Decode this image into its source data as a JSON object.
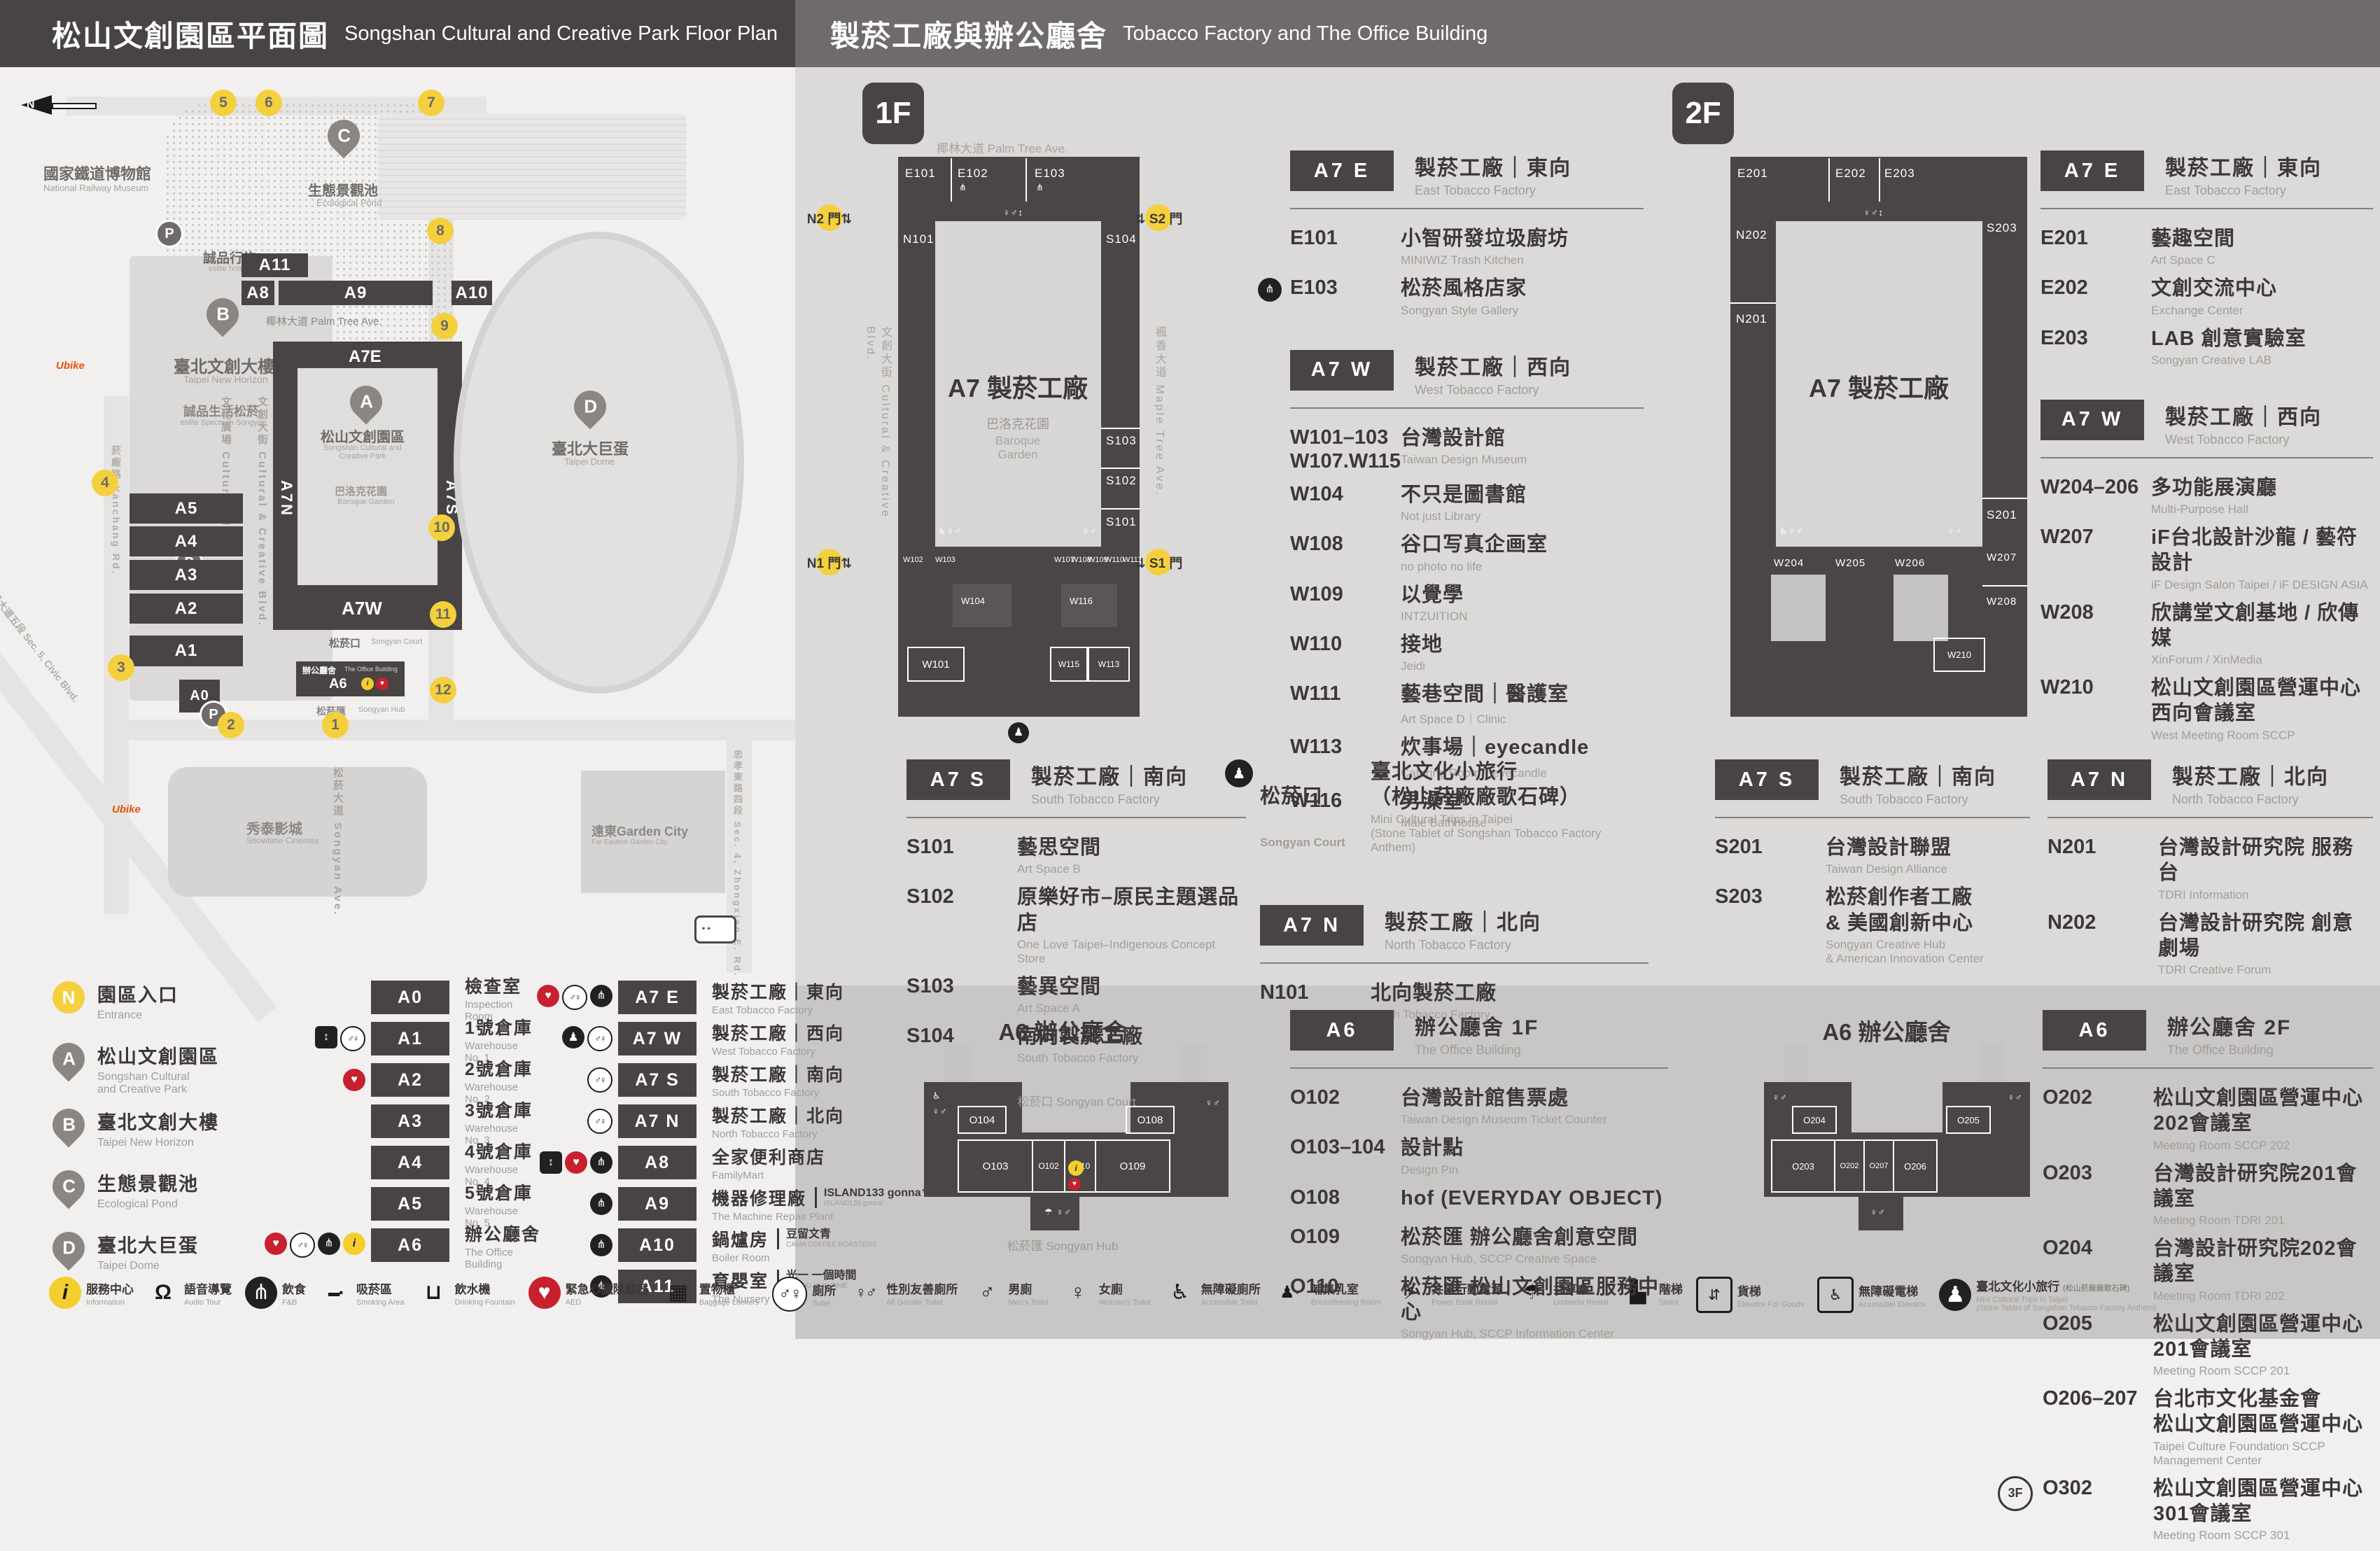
{
  "header": {
    "left_zh": "松山文創園區平面圖",
    "left_en": "Songshan Cultural and Creative Park Floor Plan",
    "right_zh": "製菸工廠與辦公廳舍",
    "right_en": "Tobacco Factory and The Office Building"
  },
  "map": {
    "north": "N",
    "railway_zh": "國家鐵道博物館",
    "railway_en": "National Railway Museum",
    "pond_zh": "生態景觀池",
    "pond_en": "Ecological Pond",
    "eslite_hotel_zh": "誠品行旅",
    "eslite_hotel_en": "eslite hotel",
    "new_horizon_zh": "臺北文創大樓",
    "new_horizon_en": "Taipei New Horizon",
    "spectrum_zh": "誠品生活松菸",
    "spectrum_en": "eslite Spectrum Songyan",
    "park_zh": "松山文創園區",
    "park_en": "Songshan Cultural and\nCreative Park",
    "baroque_zh": "巴洛克花園",
    "baroque_en": "Baroque Garden",
    "dome_zh": "臺北大巨蛋",
    "dome_en": "Taipei Dome",
    "showtime_zh": "秀泰影城",
    "showtime_en": "Showtime Cinemas",
    "garden_city": "遠東Garden City",
    "garden_city_en": "Far Eastern Garden City",
    "court_zh": "松菸口",
    "court_en": "Songyan Court",
    "office_zh": "辦公廳舍",
    "office_en": "The Office Building",
    "hub_zh": "松菸匯",
    "hub_en": "Songyan Hub",
    "palm": "椰林大道 Palm Tree Ave.",
    "cultural_plaza": "文化廣場 Cultural Plaza",
    "cc_blvd": "文創大街 Cultural & Creative Blvd.",
    "maple": "楓香大道 Maple Tree Ave.",
    "songyan_ave": "松菸大道 Songyan Ave.",
    "yanchang": "菸廠路 Yanchang Rd.",
    "civic": "市民大道五段 Sec. 5, Civic Blvd.",
    "zhongxiao": "忠孝東路四段 Sec. 4, Zhongxiao E. Rd.",
    "ub": "Ubike",
    "pins": {
      "a": "A",
      "b": "B",
      "c": "C",
      "d": "D"
    },
    "gates": [
      "1",
      "2",
      "3",
      "4",
      "5",
      "6",
      "7",
      "8",
      "9",
      "10",
      "11",
      "12"
    ],
    "b": {
      "a0": "A0",
      "a1": "A1",
      "a2": "A2",
      "a3": "A3",
      "a4": "A4",
      "a5": "A5",
      "a6": "A6",
      "a7e": "A7E",
      "a7w": "A7W",
      "a7n": "A7N",
      "a7s": "A7S",
      "a8": "A8",
      "a9": "A9",
      "a10": "A10",
      "a11": "A11"
    }
  },
  "legend": {
    "places": [
      {
        "kind": "entrance",
        "key": "N",
        "name": "entrance-marker",
        "zh": "園區入口",
        "en": "Entrance"
      },
      {
        "kind": "pin",
        "key": "A",
        "name": "pin-a",
        "zh": "松山文創園區",
        "en": "Songshan Cultural\nand Creative Park"
      },
      {
        "kind": "pin",
        "key": "B",
        "name": "pin-b",
        "zh": "臺北文創大樓",
        "en": "Taipei New Horizon"
      },
      {
        "kind": "pin",
        "key": "C",
        "name": "pin-c",
        "zh": "生態景觀池",
        "en": "Ecological Pond"
      },
      {
        "kind": "pin",
        "key": "D",
        "name": "pin-d",
        "zh": "臺北大巨蛋",
        "en": "Taipei Dome"
      }
    ],
    "buildings": [
      {
        "code": "A0",
        "zh": "檢查室",
        "en": "Inspection Room",
        "icons": []
      },
      {
        "code": "A1",
        "zh": "1號倉庫",
        "en": "Warehouse No. 1",
        "icons": [
          "elevator-icon",
          "toilet-icon"
        ]
      },
      {
        "code": "A2",
        "zh": "2號倉庫",
        "en": "Warehouse No. 2",
        "icons": [
          "aed-icon"
        ]
      },
      {
        "code": "A3",
        "zh": "3號倉庫",
        "en": "Warehouse No. 3",
        "icons": []
      },
      {
        "code": "A4",
        "zh": "4號倉庫",
        "en": "Warehouse No. 4",
        "icons": []
      },
      {
        "code": "A5",
        "zh": "5號倉庫",
        "en": "Warehouse No. 5",
        "icons": []
      },
      {
        "code": "A6",
        "zh": "辦公廳舍",
        "en": "The Office Building",
        "icons": [
          "aed-icon",
          "toilet-icon",
          "food-icon",
          "info-icon"
        ]
      }
    ],
    "factory": [
      {
        "code": "A7 E",
        "zh": "製菸工廠｜東向",
        "en": "East Tobacco Factory",
        "icons": [
          "aed-icon",
          "toilet-icon",
          "food-icon"
        ]
      },
      {
        "code": "A7 W",
        "zh": "製菸工廠｜西向",
        "en": "West Tobacco Factory",
        "icons": [
          "court-icon",
          "toilet-icon"
        ]
      },
      {
        "code": "A7 S",
        "zh": "製菸工廠｜南向",
        "en": "South Tobacco Factory",
        "icons": [
          "toilet-icon"
        ]
      },
      {
        "code": "A7 N",
        "zh": "製菸工廠｜北向",
        "en": "North Tobacco Factory",
        "icons": [
          "toilet-icon"
        ]
      },
      {
        "code": "A8",
        "zh": "全家便利商店",
        "en": "FamilyMart",
        "icons": [
          "elevator-icon",
          "aed-icon",
          "food-icon"
        ]
      },
      {
        "code": "A9",
        "zh": "機器修理廠",
        "en": "The Machine Repair Plant",
        "icons": [
          "food-icon"
        ],
        "p1": "ISLAND133 gonna⁺",
        "p2": "ISLAND133 gonna⁺"
      },
      {
        "code": "A10",
        "zh": "鍋爐房",
        "en": "Boiler Room",
        "icons": [
          "food-icon"
        ],
        "p1": "豆留文青",
        "p2": "CAMA COFFEE ROASTERS"
      },
      {
        "code": "A11",
        "zh": "育嬰室",
        "en": "The Nursery Room",
        "icons": [
          "food-icon"
        ],
        "p1": "光一 一個時間",
        "p2": "GUANG YI IN TIME"
      }
    ]
  },
  "icon_strip": [
    {
      "icon": "info-icon",
      "zh": "服務中心",
      "en": "Information"
    },
    {
      "icon": "audio-icon",
      "zh": "語音導覽",
      "en": "Audio Tour"
    },
    {
      "icon": "food-icon",
      "zh": "飲食",
      "en": "F&B"
    },
    {
      "icon": "smoke-icon",
      "zh": "吸菸區",
      "en": "Smoking Area"
    },
    {
      "icon": "water-icon",
      "zh": "飲水機",
      "en": "Drinking Fountain"
    },
    {
      "icon": "aed-icon",
      "zh": "緊急心臟除顫器",
      "en": "AED"
    },
    {
      "icon": "locker-icon",
      "zh": "置物櫃",
      "en": "Baggage Lockers"
    },
    {
      "icon": "toilet-icon",
      "zh": "廁所",
      "en": "Toilet"
    },
    {
      "icon": "allgender-icon",
      "zh": "性別友善廁所",
      "en": "All Gender Toilet"
    },
    {
      "icon": "men-icon",
      "zh": "男廁",
      "en": "Men's Toilet"
    },
    {
      "icon": "women-icon",
      "zh": "女廁",
      "en": "Women's Toilet"
    },
    {
      "icon": "access-icon",
      "zh": "無障礙廁所",
      "en": "Accessible Toilet"
    },
    {
      "icon": "nursing-icon",
      "zh": "哺集乳室",
      "en": "Breastfeeding Room"
    },
    {
      "icon": "power-icon",
      "zh": "共享行動電源",
      "en": "Power Bank Rental"
    },
    {
      "icon": "umbrella-icon",
      "zh": "共享傘",
      "en": "Umbrella Rental"
    },
    {
      "icon": "stairs-icon",
      "zh": "階梯",
      "en": "Stairs"
    },
    {
      "icon": "goods-elevator-icon",
      "zh": "貨梯",
      "en": "Elevator For Goods"
    },
    {
      "icon": "accessible-elevator-icon",
      "zh": "無障礙電梯",
      "en": "Accessible Elevator"
    },
    {
      "icon": "court-icon",
      "zh": "臺北文化小旅行",
      "zh2": "(松山菸廠廠歌石碑)",
      "en": "Mini Cultural Trips in Taipei\n(Stone Tablet of Songshan Tobacco Factory Anthem)"
    }
  ],
  "f1": {
    "badge": "1F",
    "plan": {
      "street": "椰林大道 Palm Tree Ave.",
      "left_street": "文創大街 Cultural & Creative Blvd.",
      "right_street": "楓香大道 Maple Tree Ave.",
      "center_zh": "A7 製菸工廠",
      "court_zh": "巴洛克花園",
      "court_en": "Baroque\nGarden",
      "gates": {
        "n2": "N2 門⇅",
        "s2": "⇅ S2 門",
        "n1": "N1 門⇅",
        "s1": "⇅ S1 門"
      },
      "rooms": {
        "e101": "E101",
        "e102": "E102",
        "e103": "E103",
        "n101": "N101",
        "s101": "S101",
        "s102": "S102",
        "s103": "S103",
        "s104": "S104",
        "w101": "W101",
        "w102": "W102",
        "w103": "W103",
        "w104": "W104",
        "w107": "W107",
        "w108": "W108",
        "w109": "W109",
        "w110": "W110",
        "w111": "W111",
        "w113": "W113",
        "w115": "W115",
        "w116": "W116"
      }
    },
    "sections_main": [
      {
        "badge": "A7 E",
        "zh": "製菸工廠｜東向",
        "en": "East Tobacco Factory",
        "rows": [
          {
            "code": "E101",
            "zh": "小智研發垃圾廚坊",
            "en": "MINIWIZ Trash Kitchen"
          },
          {
            "icon": "food-icon",
            "code": "E103",
            "zh": "松菸風格店家",
            "en": "Songyan Style Gallery"
          }
        ]
      },
      {
        "badge": "A7 W",
        "zh": "製菸工廠｜西向",
        "en": "West Tobacco Factory",
        "rows": [
          {
            "code": "W101–103\nW107.W115",
            "zh": "台灣設計館",
            "en": "Taiwan Design Museum"
          },
          {
            "code": "W104",
            "zh": "不只是圖書館",
            "en": "Not just Library"
          },
          {
            "code": "W108",
            "zh": "谷口写真企画室",
            "en": "no photo no life"
          },
          {
            "code": "W109",
            "zh": "以覺學",
            "en": "INTZUITION"
          },
          {
            "code": "W110",
            "zh": "接地",
            "en": "Jeidi"
          },
          {
            "code": "W111",
            "zh": "藝巷空間｜醫護室",
            "en": "Art Space D｜Clinic"
          },
          {
            "code": "W113",
            "zh": "炊事場｜eyecandle",
            "en": "Catering Room｜eyecandle"
          },
          {
            "code": "W116",
            "zh": "男澡堂",
            "en": "Male Bathhouse"
          }
        ]
      }
    ],
    "sections_south": [
      {
        "badge": "A7 S",
        "zh": "製菸工廠｜南向",
        "en": "South Tobacco Factory",
        "rows": [
          {
            "code": "S101",
            "zh": "藝思空間",
            "en": "Art Space B"
          },
          {
            "code": "S102",
            "zh": "原樂好市–原民主題選品店",
            "en": "One Love Taipei–Indigenous Concept Store"
          },
          {
            "code": "S103",
            "zh": "藝異空間",
            "en": "Art Space A"
          },
          {
            "code": "S104",
            "zh": "南向製菸工廠",
            "en": "South Tobacco Factory"
          }
        ]
      }
    ],
    "court": {
      "icon": "court-icon",
      "zh": "松菸口",
      "en": "Songyan Court",
      "name_zh": "臺北文化小旅行\n（松山菸廠廠歌石碑）",
      "name_en": "Mini Cultural Trips in Taipei\n(Stone Tablet of Songshan Tobacco Factory Anthem)"
    },
    "sections_north": [
      {
        "badge": "A7 N",
        "zh": "製菸工廠｜北向",
        "en": "North Tobacco Factory",
        "rows": [
          {
            "code": "N101",
            "zh": "北向製菸工廠",
            "en": "North Tobacco Factory"
          }
        ]
      }
    ],
    "a6_plan": {
      "title": "A6 辦公廳舍",
      "court": "松菸口 Songyan Court",
      "hub": "松菸匯 Songyan Hub",
      "rooms": {
        "o102": "O102",
        "o103": "O103",
        "o104": "O104",
        "o108": "O108",
        "o109": "O109",
        "o110": "O110"
      }
    },
    "a6_list": {
      "badge": "A6",
      "zh": "辦公廳舍 1F",
      "en": "The Office Building",
      "rows": [
        {
          "code": "O102",
          "zh": "台灣設計館售票處",
          "en": "Taiwan Design Museum Ticket Counter"
        },
        {
          "code": "O103–104",
          "zh": "設計點",
          "en": "Design Pin"
        },
        {
          "code": "O108",
          "zh": "hof (EVERYDAY OBJECT)"
        },
        {
          "code": "O109",
          "zh": "松菸匯 辦公廳舍創意空間",
          "en": "Songyan Hub, SCCP Creative Space"
        },
        {
          "code": "O110",
          "zh": "松菸匯 松山文創園區服務中心",
          "en": "Songyan Hub, SCCP Information Center"
        }
      ]
    }
  },
  "f2": {
    "badge": "2F",
    "plan": {
      "center_zh": "A7 製菸工廠",
      "rooms": {
        "e201": "E201",
        "e202": "E202",
        "e203": "E203",
        "n201": "N201",
        "n202": "N202",
        "s201": "S201",
        "s203": "S203",
        "w204": "W204",
        "w205": "W205",
        "w206": "W206",
        "w207": "W207",
        "w208": "W208",
        "w210": "W210"
      }
    },
    "sections_main": [
      {
        "badge": "A7 E",
        "zh": "製菸工廠｜東向",
        "en": "East Tobacco Factory",
        "rows": [
          {
            "code": "E201",
            "zh": "藝趣空間",
            "en": "Art Space C"
          },
          {
            "code": "E202",
            "zh": "文創交流中心",
            "en": "Exchange Center"
          },
          {
            "code": "E203",
            "zh": "LAB 創意實驗室",
            "en": "Songyan Creative LAB"
          }
        ]
      },
      {
        "badge": "A7 W",
        "zh": "製菸工廠｜西向",
        "en": "West Tobacco Factory",
        "rows": [
          {
            "code": "W204–206",
            "zh": "多功能展演廳",
            "en": "Multi-Purpose Hall"
          },
          {
            "code": "W207",
            "zh": "iF台北設計沙龍 / 藝符設計",
            "en": "iF Design Salon Taipei / iF DESIGN ASIA"
          },
          {
            "code": "W208",
            "zh": "欣講堂文創基地 / 欣傳媒",
            "en": "XinForum / XinMedia"
          },
          {
            "code": "W210",
            "zh": "松山文創園區營運中心\n西向會議室",
            "en": "West Meeting Room SCCP"
          }
        ]
      }
    ],
    "sections_south": [
      {
        "badge": "A7 S",
        "zh": "製菸工廠｜南向",
        "en": "South Tobacco Factory",
        "rows": [
          {
            "code": "S201",
            "zh": "台灣設計聯盟",
            "en": "Taiwan Design Alliance"
          },
          {
            "code": "S203",
            "zh": "松菸創作者工廠\n& 美國創新中心",
            "en": "Songyan Creative Hub\n& American Innovation Center"
          }
        ]
      }
    ],
    "sections_north": [
      {
        "badge": "A7 N",
        "zh": "製菸工廠｜北向",
        "en": "North Tobacco Factory",
        "rows": [
          {
            "code": "N201",
            "zh": "台灣設計研究院 服務台",
            "en": "TDRI Information"
          },
          {
            "code": "N202",
            "zh": "台灣設計研究院 創意劇場",
            "en": "TDRI Creative Forum"
          }
        ]
      }
    ],
    "a6_plan": {
      "title": "A6 辦公廳舍",
      "rooms": {
        "o202": "O202",
        "o203": "O203",
        "o204": "O204",
        "o205": "O205",
        "o206": "O206",
        "o207": "O207"
      }
    },
    "a6_list": {
      "badge": "A6",
      "zh": "辦公廳舍 2F",
      "en": "The Office Building",
      "rows": [
        {
          "code": "O202",
          "zh": "松山文創園區營運中心202會議室",
          "en": "Meeting Room SCCP 202"
        },
        {
          "code": "O203",
          "zh": "台灣設計研究院201會議室",
          "en": "Meeting Room TDRI 201"
        },
        {
          "code": "O204",
          "zh": "台灣設計研究院202會議室",
          "en": "Meeting Room TDRI 202"
        },
        {
          "code": "O205",
          "zh": "松山文創園區營運中心201會議室",
          "en": "Meeting Room SCCP 201"
        },
        {
          "code": "O206–207",
          "zh": "台北市文化基金會\n松山文創園區營運中心",
          "en": "Taipei Culture Foundation SCCP Management Center"
        },
        {
          "pre": "3F",
          "code": "O302",
          "zh": "松山文創園區營運中心301會議室",
          "en": "Meeting Room SCCP 301"
        }
      ]
    }
  }
}
